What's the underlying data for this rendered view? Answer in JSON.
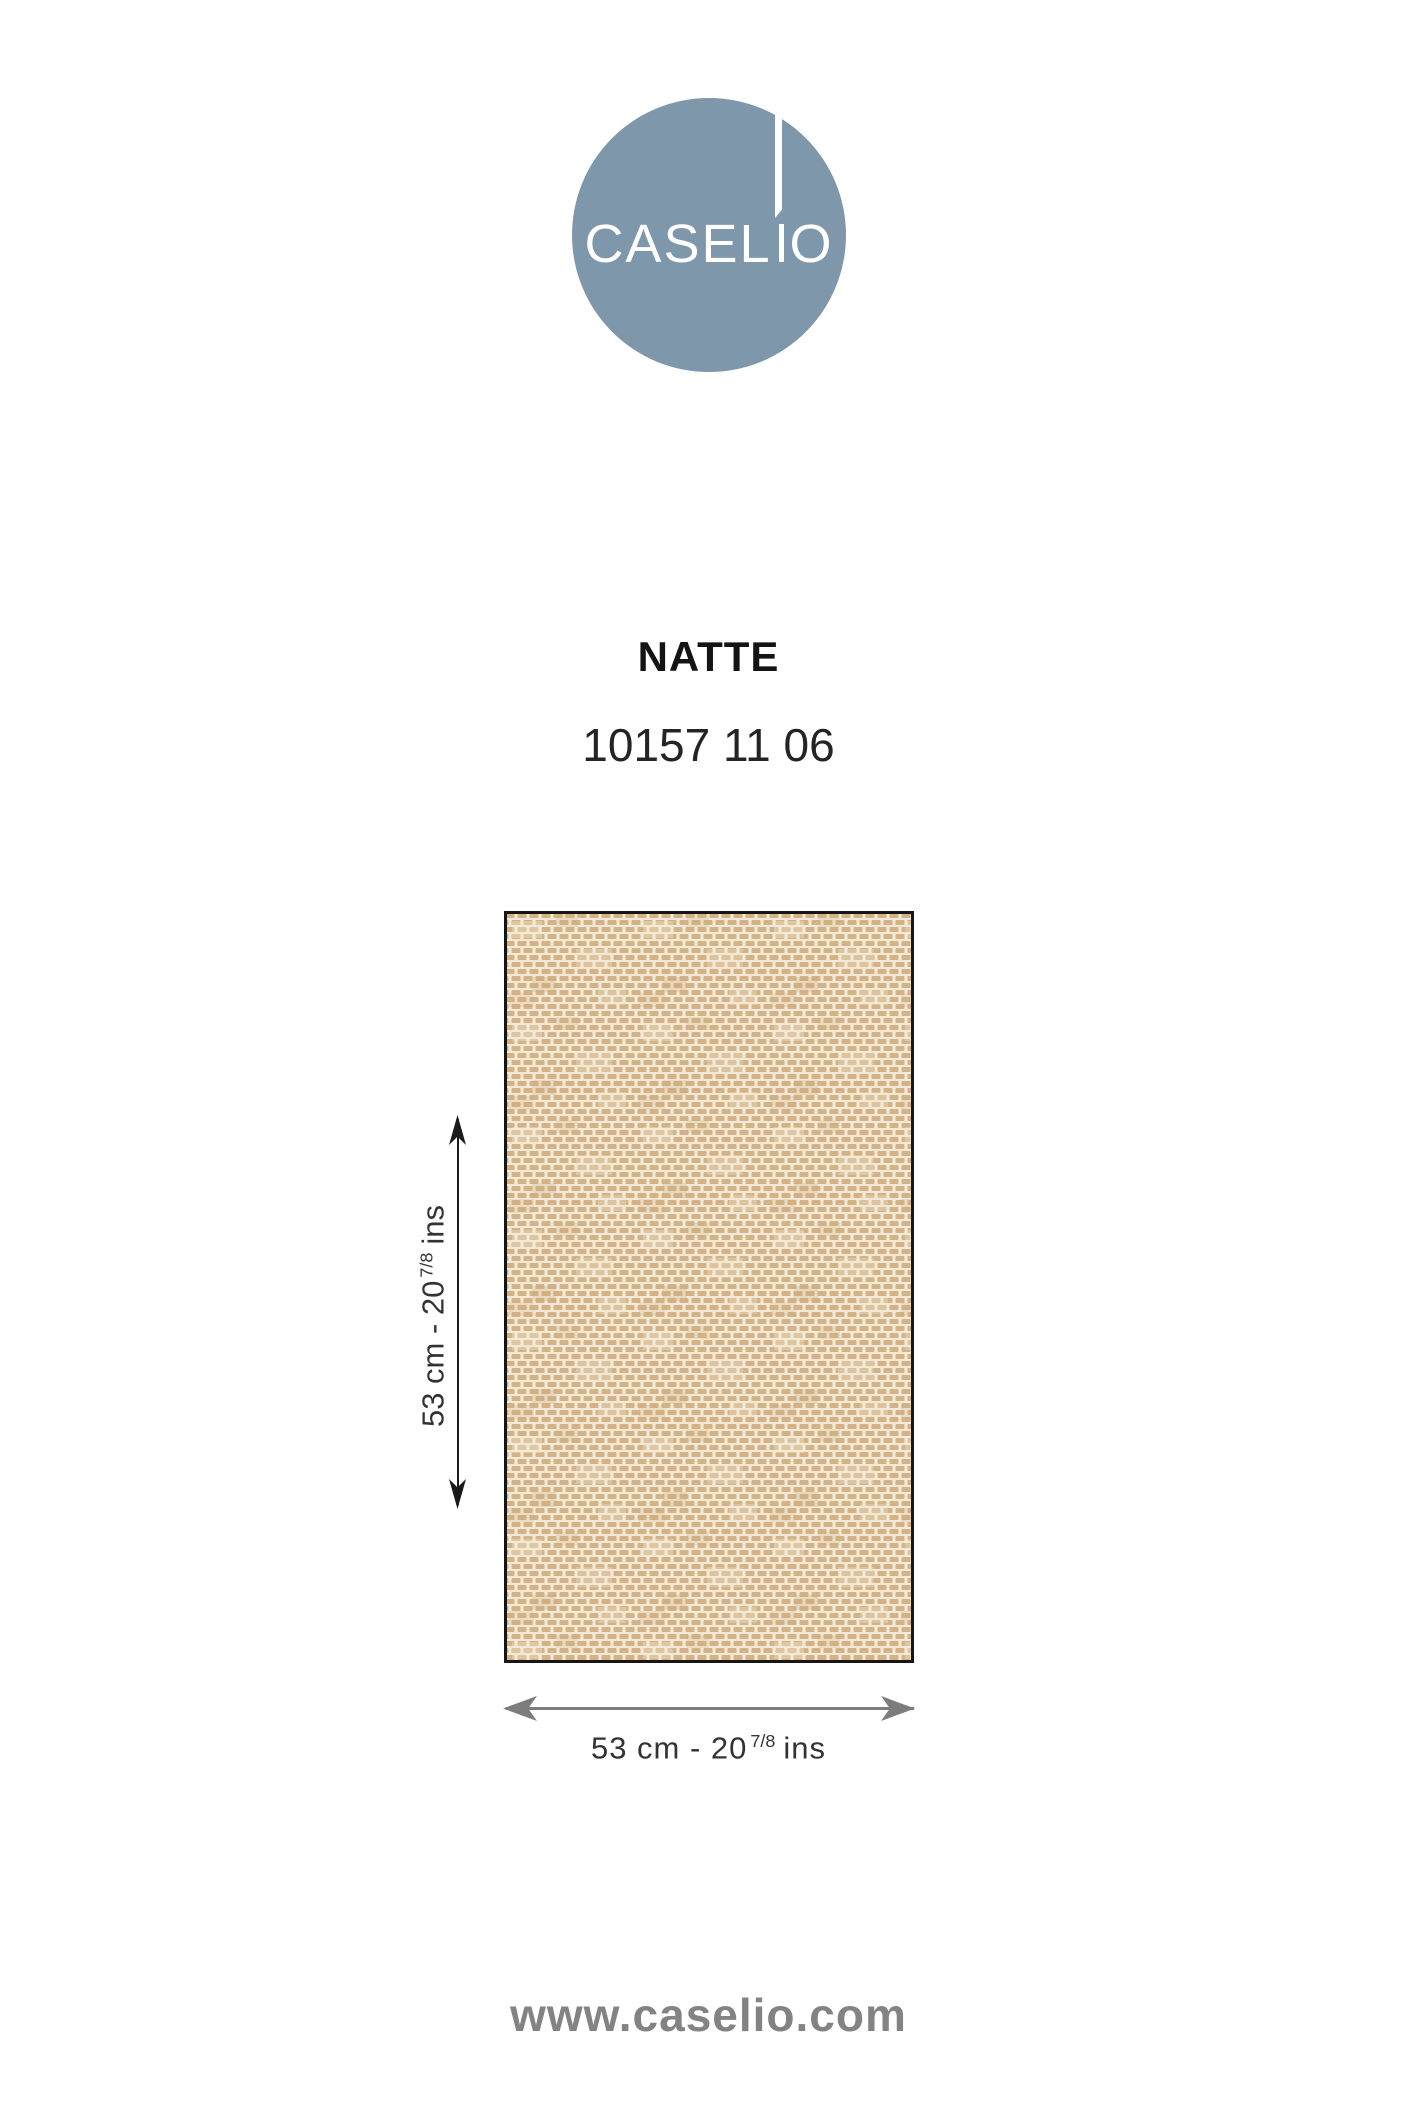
{
  "brand": {
    "name": "CASELIO",
    "wordmark_pre": "CASEL",
    "wordmark_post": "O",
    "circle_color": "#7E97AA",
    "wordmark_color": "#FFFFFF"
  },
  "product": {
    "name": "NATTE",
    "reference": "10157 11 06"
  },
  "swatch": {
    "description": "beige woven basket-weave wallpaper sample",
    "background_color": "#F2EAD6",
    "weave_color": "#D4B286",
    "weave_color_dark": "#C8A878",
    "border_color": "#161616"
  },
  "dimensions": {
    "height": {
      "prefix": "53 cm - 20",
      "fraction": "7/8",
      "suffix": "ins"
    },
    "width": {
      "prefix": "53 cm - 20",
      "fraction": "7/8",
      "suffix": "ins"
    },
    "height_arrow_color": "#1A1A1A",
    "width_arrow_color": "#7D7D7D"
  },
  "footer": {
    "website": "www.caselio.com",
    "color": "#838383"
  }
}
